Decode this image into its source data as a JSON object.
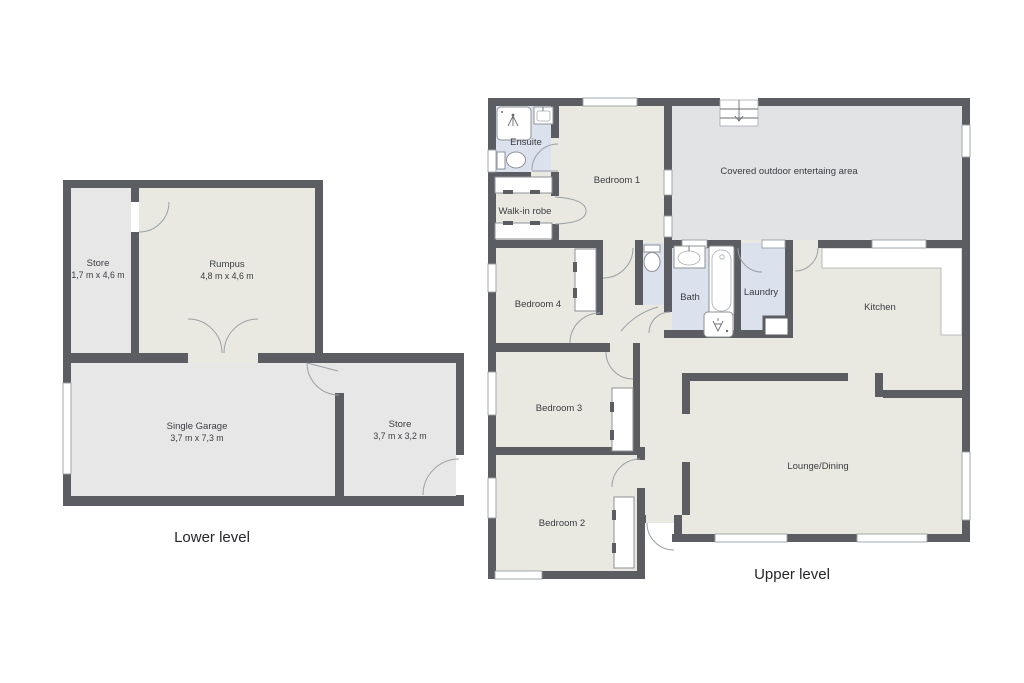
{
  "colors": {
    "wall": "#5b5d62",
    "floor_living": "#e9e9e1",
    "floor_garage": "#e7e7e8",
    "floor_outdoor": "#e2e3e4",
    "floor_wet": "#dbe2ee",
    "door_line": "#9aa0a5",
    "text": "#3a3c40"
  },
  "lower_level": {
    "label": "Lower level",
    "rooms": [
      {
        "name": "Store",
        "dims": "1,7 m x 4,6 m"
      },
      {
        "name": "Rumpus",
        "dims": "4,8 m x 4,6 m"
      },
      {
        "name": "Single Garage",
        "dims": "3,7 m x 7,3 m"
      },
      {
        "name": "Store",
        "dims": "3,7 m x 3,2 m"
      }
    ]
  },
  "upper_level": {
    "label": "Upper level",
    "rooms": [
      {
        "name": "Ensuite"
      },
      {
        "name": "Bedroom 1"
      },
      {
        "name": "Covered outdoor entertaing area"
      },
      {
        "name": "Walk-in robe"
      },
      {
        "name": "Bedroom 4"
      },
      {
        "name": "Bath"
      },
      {
        "name": "Laundry"
      },
      {
        "name": "Kitchen"
      },
      {
        "name": "Bedroom 3"
      },
      {
        "name": "Lounge/Dining"
      },
      {
        "name": "Bedroom 2"
      }
    ]
  }
}
